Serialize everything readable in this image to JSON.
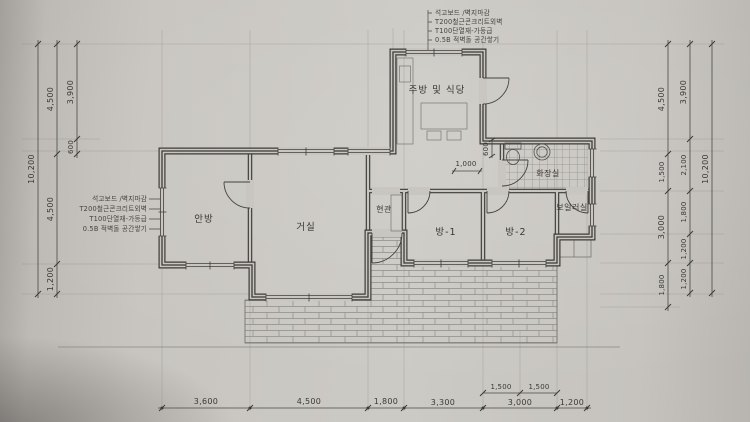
{
  "notes": [
    "석고보드 /벽지마감",
    "T200철근콘크리트외벽",
    "T100단열재-가등급",
    "0.5B 적벽돌 공간쌓기"
  ],
  "rooms": {
    "kitchen_dining": "주방 및 식당",
    "master_bedroom": "안방",
    "living_room": "거실",
    "entrance": "현관",
    "bedroom1": "방-1",
    "bedroom2": "방-2",
    "bathroom": "화장실",
    "boiler_room": "보일러실"
  },
  "dims": {
    "left_total": "10,200",
    "left_upper": "4,500",
    "left_lower": "4,500",
    "left_bottom": "1,200",
    "left_kitchen_depth": "3,900",
    "left_offset": "600",
    "right_inner_top": "4,500",
    "right_inner_hall": "1,500",
    "right_inner_rooms": "3,000",
    "right_inner_porch": "1,800",
    "right_mid_top": "3,900",
    "right_mid_bath": "2,100",
    "right_mid_boiler": "1,800",
    "right_mid_a": "1,200",
    "right_mid_b": "1,200",
    "right_total": "10,200",
    "bottom_1": "3,600",
    "bottom_2": "4,500",
    "bottom_3": "1,800",
    "bottom_4": "3,300",
    "bottom_5": "3,000",
    "bottom_6": "1,200",
    "bottom_sub_1": "1,500",
    "bottom_sub_2": "1,500",
    "hall_width": "1,000",
    "bath_offset": "600"
  },
  "colors": {
    "paper": "#c9c6c1",
    "wall_line": "#3d3b37",
    "dim_line": "#4a4845"
  }
}
